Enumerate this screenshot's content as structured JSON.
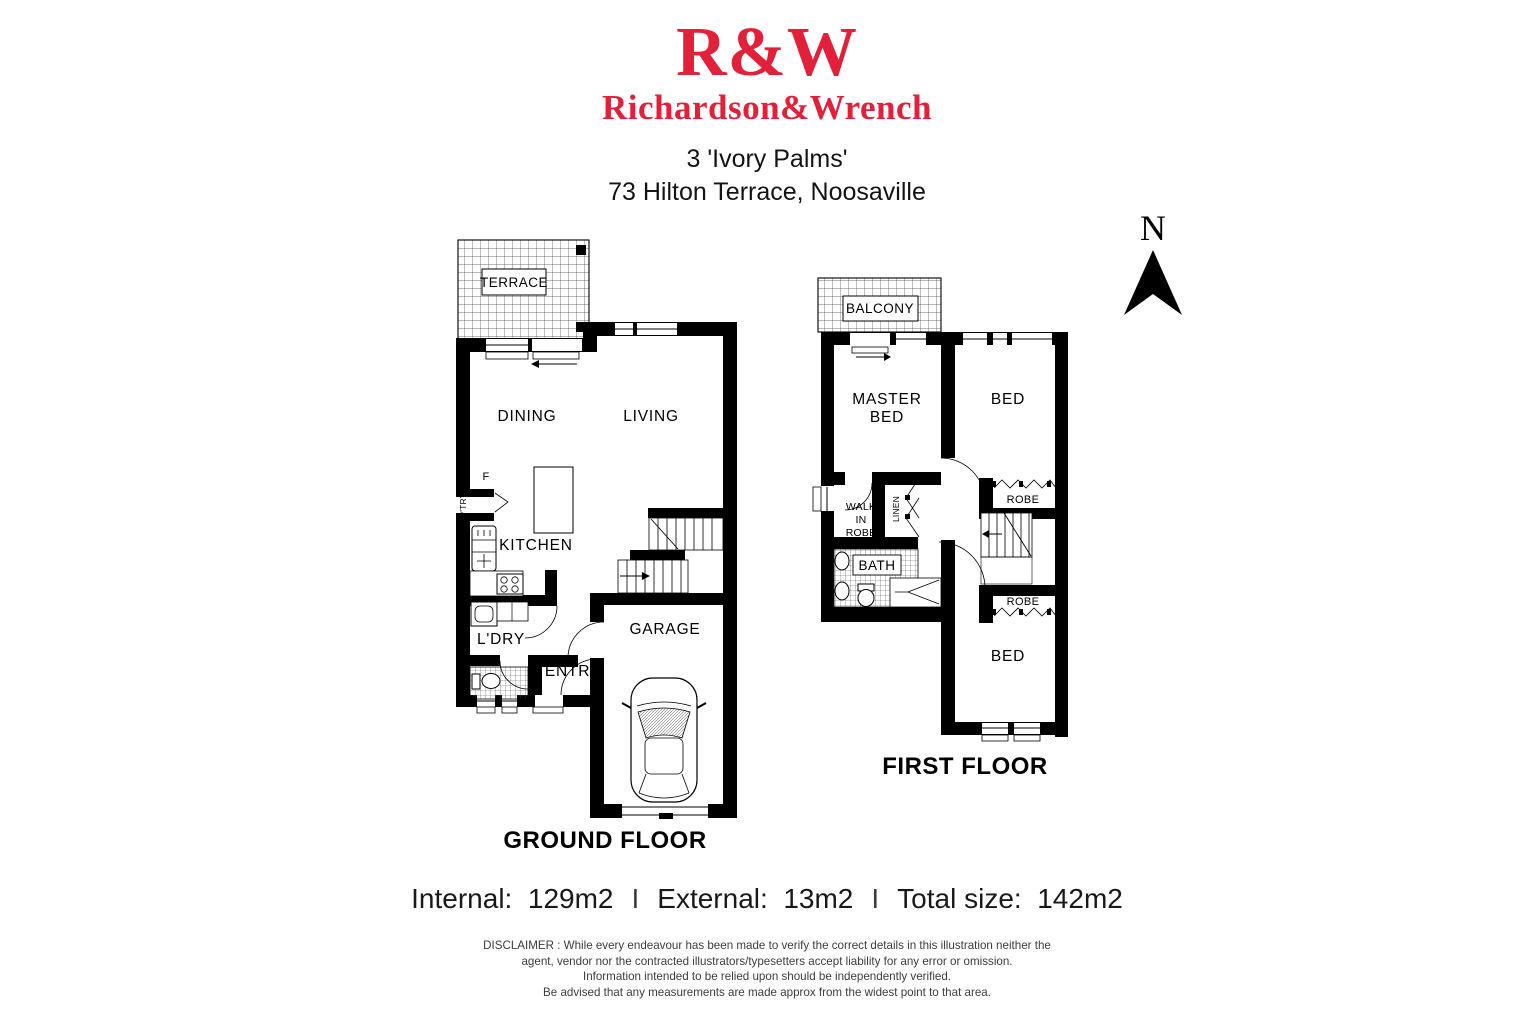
{
  "header": {
    "logo_monogram": "R&W",
    "logo_wordmark": "Richardson&Wrench",
    "address_line1": "3 'Ivory Palms'",
    "address_line2": "73 Hilton Terrace, Noosaville"
  },
  "compass": {
    "north_label": "N"
  },
  "ground_floor": {
    "title": "GROUND FLOOR",
    "rooms": {
      "terrace": "TERRACE",
      "dining": "DINING",
      "living": "LIVING",
      "fridge": "F",
      "pantry": "P'TRY",
      "kitchen": "KITCHEN",
      "laundry": "L'DRY",
      "entry": "ENTRY",
      "garage": "GARAGE"
    }
  },
  "first_floor": {
    "title": "FIRST FLOOR",
    "rooms": {
      "balcony": "BALCONY",
      "master_bed_line1": "MASTER",
      "master_bed_line2": "BED",
      "bed_front": "BED",
      "walk_in_robe_line1": "WALK",
      "walk_in_robe_line2": "IN",
      "walk_in_robe_line3": "ROBE",
      "linen": "LINEN",
      "robe_upper": "ROBE",
      "bath": "BATH",
      "robe_lower": "ROBE",
      "bed_rear": "BED"
    }
  },
  "area_summary": {
    "internal": "Internal:  129m2",
    "separator1": "I",
    "external": "External:  13m2",
    "separator2": "I",
    "total": "Total size:  142m2"
  },
  "disclaimer": {
    "lines": [
      "DISCLAIMER : While every endeavour has been made to verify the correct details in this illustration neither the",
      "agent, vendor nor the contracted illustrators/typesetters accept liability for any error or omission.",
      "Information intended to be relied upon should be independently verified.",
      "Be advised that any measurements are made approx from the widest point to that area."
    ]
  },
  "colors": {
    "brand_red": "#e2203a",
    "plan_ink": "#000000"
  }
}
